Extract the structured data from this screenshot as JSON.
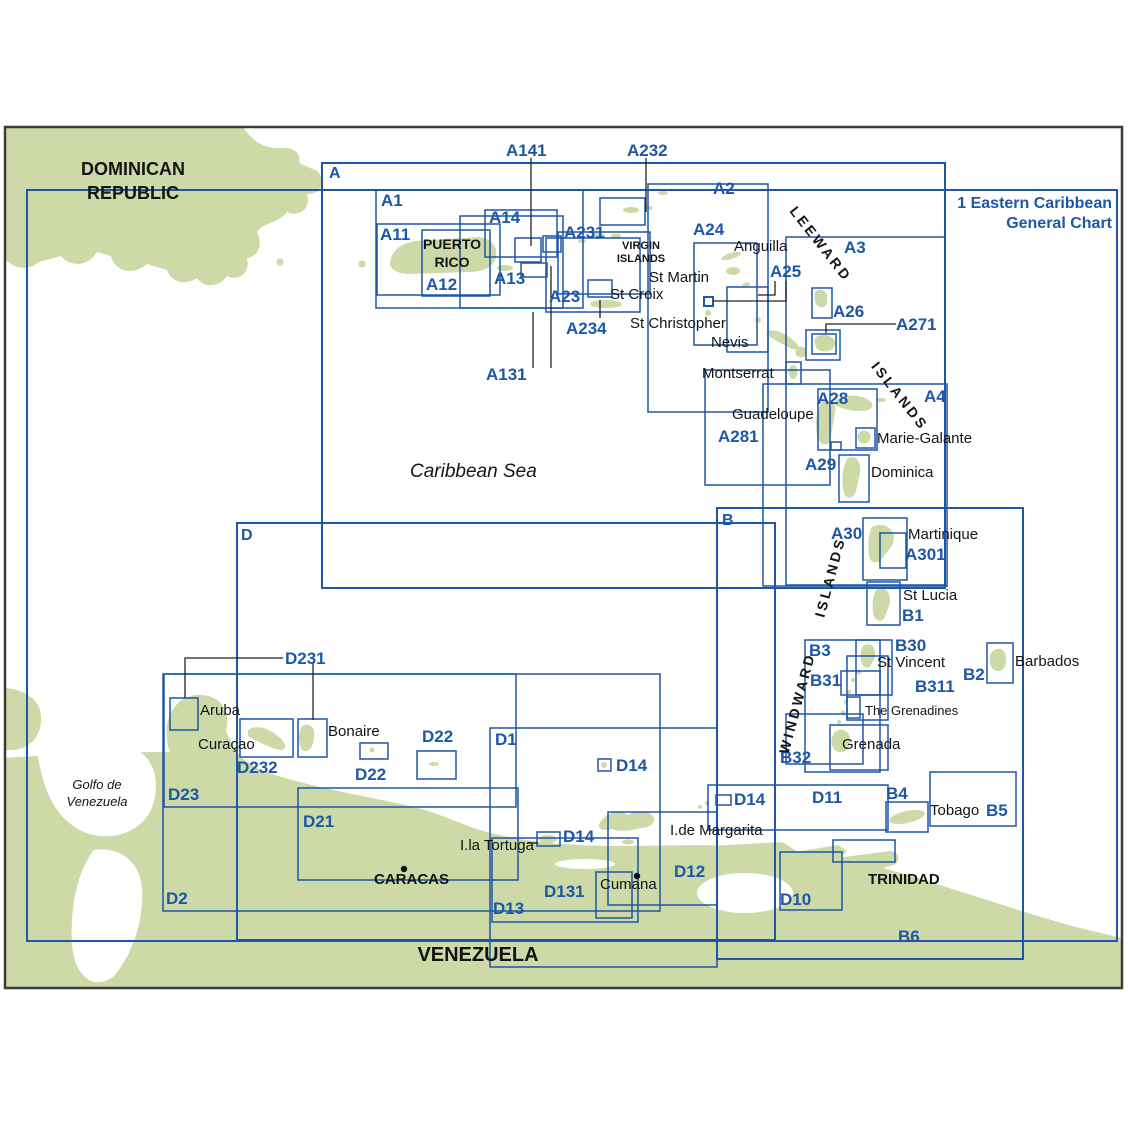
{
  "meta": {
    "title": "Eastern Caribbean chart index map",
    "colors": {
      "land": "#cdd9a6",
      "chart_line": "#1d57a5",
      "chart_text": "#1d57a5",
      "map_border": "#3c3c3c",
      "place_text": "#141414",
      "sea": "#ffffff"
    }
  },
  "general_chart": {
    "line1": "1 Eastern Caribbean",
    "line2": "General Chart"
  },
  "labels": [
    {
      "t": "1 Eastern Caribbean",
      "x": 1112,
      "y": 196,
      "c": "blue",
      "b": 1,
      "s": 16,
      "al": "right"
    },
    {
      "t": "General Chart",
      "x": 1112,
      "y": 216,
      "c": "blue",
      "b": 1,
      "s": 16,
      "al": "right"
    },
    {
      "t": "A",
      "x": 329,
      "y": 166,
      "c": "blue",
      "b": 1,
      "s": 16
    },
    {
      "t": "B",
      "x": 722,
      "y": 513,
      "c": "blue",
      "b": 1,
      "s": 16
    },
    {
      "t": "D",
      "x": 241,
      "y": 528,
      "c": "blue",
      "b": 1,
      "s": 16
    },
    {
      "t": "A1",
      "x": 381,
      "y": 192,
      "c": "blue",
      "b": 1,
      "s": 17
    },
    {
      "t": "A11",
      "x": 380,
      "y": 226,
      "c": "blue",
      "b": 1,
      "s": 17
    },
    {
      "t": "A12",
      "x": 426,
      "y": 276,
      "c": "blue",
      "b": 1,
      "s": 17
    },
    {
      "t": "A13",
      "x": 494,
      "y": 270,
      "c": "blue",
      "b": 1,
      "s": 17
    },
    {
      "t": "A14",
      "x": 489,
      "y": 209,
      "c": "blue",
      "b": 1,
      "s": 17
    },
    {
      "t": "A141",
      "x": 506,
      "y": 142,
      "c": "blue",
      "b": 1,
      "s": 17
    },
    {
      "t": "A232",
      "x": 627,
      "y": 142,
      "c": "blue",
      "b": 1,
      "s": 17
    },
    {
      "t": "A231",
      "x": 564,
      "y": 224,
      "c": "blue",
      "b": 1,
      "s": 17
    },
    {
      "t": "A2",
      "x": 713,
      "y": 180,
      "c": "blue",
      "b": 1,
      "s": 17
    },
    {
      "t": "A23",
      "x": 549,
      "y": 288,
      "c": "blue",
      "b": 1,
      "s": 17
    },
    {
      "t": "A234",
      "x": 566,
      "y": 320,
      "c": "blue",
      "b": 1,
      "s": 17
    },
    {
      "t": "A131",
      "x": 486,
      "y": 366,
      "c": "blue",
      "b": 1,
      "s": 17
    },
    {
      "t": "A24",
      "x": 693,
      "y": 221,
      "c": "blue",
      "b": 1,
      "s": 17
    },
    {
      "t": "A25",
      "x": 770,
      "y": 263,
      "c": "blue",
      "b": 1,
      "s": 17
    },
    {
      "t": "A3",
      "x": 844,
      "y": 239,
      "c": "blue",
      "b": 1,
      "s": 17
    },
    {
      "t": "A26",
      "x": 833,
      "y": 303,
      "c": "blue",
      "b": 1,
      "s": 17
    },
    {
      "t": "A271",
      "x": 896,
      "y": 316,
      "c": "blue",
      "b": 1,
      "s": 17
    },
    {
      "t": "A28",
      "x": 817,
      "y": 390,
      "c": "blue",
      "b": 1,
      "s": 17
    },
    {
      "t": "A281",
      "x": 718,
      "y": 428,
      "c": "blue",
      "b": 1,
      "s": 17
    },
    {
      "t": "A29",
      "x": 805,
      "y": 456,
      "c": "blue",
      "b": 1,
      "s": 17
    },
    {
      "t": "A4",
      "x": 924,
      "y": 388,
      "c": "blue",
      "b": 1,
      "s": 17
    },
    {
      "t": "A30",
      "x": 831,
      "y": 525,
      "c": "blue",
      "b": 1,
      "s": 17
    },
    {
      "t": "A301",
      "x": 905,
      "y": 546,
      "c": "blue",
      "b": 1,
      "s": 17
    },
    {
      "t": "B1",
      "x": 902,
      "y": 607,
      "c": "blue",
      "b": 1,
      "s": 17
    },
    {
      "t": "B3",
      "x": 809,
      "y": 642,
      "c": "blue",
      "b": 1,
      "s": 17
    },
    {
      "t": "B30",
      "x": 895,
      "y": 637,
      "c": "blue",
      "b": 1,
      "s": 17
    },
    {
      "t": "B31",
      "x": 810,
      "y": 672,
      "c": "blue",
      "b": 1,
      "s": 17
    },
    {
      "t": "B311",
      "x": 915,
      "y": 678,
      "c": "blue",
      "b": 1,
      "s": 17
    },
    {
      "t": "B2",
      "x": 963,
      "y": 666,
      "c": "blue",
      "b": 1,
      "s": 17
    },
    {
      "t": "B32",
      "x": 780,
      "y": 749,
      "c": "blue",
      "b": 1,
      "s": 17
    },
    {
      "t": "B4",
      "x": 886,
      "y": 785,
      "c": "blue",
      "b": 1,
      "s": 17
    },
    {
      "t": "B5",
      "x": 986,
      "y": 802,
      "c": "blue",
      "b": 1,
      "s": 17
    },
    {
      "t": "B6",
      "x": 898,
      "y": 928,
      "c": "blue",
      "b": 1,
      "s": 17
    },
    {
      "t": "D231",
      "x": 285,
      "y": 650,
      "c": "blue",
      "b": 1,
      "s": 17
    },
    {
      "t": "D232",
      "x": 237,
      "y": 759,
      "c": "blue",
      "b": 1,
      "s": 17
    },
    {
      "t": "D23",
      "x": 168,
      "y": 786,
      "c": "blue",
      "b": 1,
      "s": 17
    },
    {
      "t": "D22",
      "x": 355,
      "y": 766,
      "c": "blue",
      "b": 1,
      "s": 17
    },
    {
      "t": "D22",
      "x": 422,
      "y": 728,
      "c": "blue",
      "b": 1,
      "s": 17
    },
    {
      "t": "D1",
      "x": 495,
      "y": 731,
      "c": "blue",
      "b": 1,
      "s": 17
    },
    {
      "t": "D14",
      "x": 616,
      "y": 757,
      "c": "blue",
      "b": 1,
      "s": 17
    },
    {
      "t": "D14",
      "x": 734,
      "y": 791,
      "c": "blue",
      "b": 1,
      "s": 17
    },
    {
      "t": "D14",
      "x": 563,
      "y": 828,
      "c": "blue",
      "b": 1,
      "s": 17
    },
    {
      "t": "D21",
      "x": 303,
      "y": 813,
      "c": "blue",
      "b": 1,
      "s": 17
    },
    {
      "t": "D12",
      "x": 674,
      "y": 863,
      "c": "blue",
      "b": 1,
      "s": 17
    },
    {
      "t": "D131",
      "x": 544,
      "y": 883,
      "c": "blue",
      "b": 1,
      "s": 17
    },
    {
      "t": "D13",
      "x": 493,
      "y": 900,
      "c": "blue",
      "b": 1,
      "s": 17
    },
    {
      "t": "D11",
      "x": 812,
      "y": 789,
      "c": "blue",
      "b": 1,
      "s": 17
    },
    {
      "t": "D10",
      "x": 780,
      "y": 891,
      "c": "blue",
      "b": 1,
      "s": 17
    },
    {
      "t": "D2",
      "x": 166,
      "y": 890,
      "c": "blue",
      "b": 1,
      "s": 17
    },
    {
      "t": "DOMINICAN",
      "x": 133,
      "y": 160,
      "c": "black",
      "b": 1,
      "s": 18,
      "al": "center"
    },
    {
      "t": "REPUBLIC",
      "x": 133,
      "y": 184,
      "c": "black",
      "b": 1,
      "s": 18,
      "al": "center"
    },
    {
      "t": "PUERTO",
      "x": 452,
      "y": 237,
      "c": "black",
      "b": 1,
      "s": 14,
      "al": "center"
    },
    {
      "t": "RICO",
      "x": 452,
      "y": 255,
      "c": "black",
      "b": 1,
      "s": 14,
      "al": "center"
    },
    {
      "t": "VIRGIN",
      "x": 641,
      "y": 241,
      "c": "black",
      "b": 1,
      "s": 11,
      "al": "center"
    },
    {
      "t": "ISLANDS",
      "x": 641,
      "y": 254,
      "c": "black",
      "b": 1,
      "s": 11,
      "al": "center"
    },
    {
      "t": "CARACAS",
      "x": 374,
      "y": 872,
      "c": "black",
      "b": 1,
      "s": 15
    },
    {
      "t": "TRINIDAD",
      "x": 868,
      "y": 872,
      "c": "black",
      "b": 1,
      "s": 15
    },
    {
      "t": "VENEZUELA",
      "x": 478,
      "y": 945,
      "c": "black",
      "b": 1,
      "s": 20,
      "al": "center"
    },
    {
      "t": "Caribbean Sea",
      "x": 410,
      "y": 462,
      "c": "black",
      "i": 1,
      "s": 19
    },
    {
      "t": "Golfo de",
      "x": 97,
      "y": 778,
      "c": "black",
      "i": 1,
      "s": 13,
      "al": "center"
    },
    {
      "t": "Venezuela",
      "x": 97,
      "y": 795,
      "c": "black",
      "i": 1,
      "s": 13,
      "al": "center"
    },
    {
      "t": "LEEWARD",
      "x": 821,
      "y": 244,
      "c": "black",
      "b": 1,
      "s": 14,
      "ang": 52
    },
    {
      "t": "ISLANDS",
      "x": 900,
      "y": 396,
      "c": "black",
      "b": 1,
      "s": 14,
      "ang": 52
    },
    {
      "t": "ISLANDS",
      "x": 830,
      "y": 577,
      "c": "black",
      "b": 1,
      "s": 14,
      "ang": -75
    },
    {
      "t": "WINDWARD",
      "x": 797,
      "y": 703,
      "c": "black",
      "b": 1,
      "s": 14,
      "ang": -75
    },
    {
      "t": "Anguilla",
      "x": 734,
      "y": 239,
      "c": "black",
      "s": 15
    },
    {
      "t": "St Martin",
      "x": 649,
      "y": 270,
      "c": "black",
      "s": 15
    },
    {
      "t": "St Croix",
      "x": 610,
      "y": 287,
      "c": "black",
      "s": 15
    },
    {
      "t": "St Christopher",
      "x": 630,
      "y": 316,
      "c": "black",
      "s": 15
    },
    {
      "t": "Nevis",
      "x": 711,
      "y": 335,
      "c": "black",
      "s": 15
    },
    {
      "t": "Montserrat",
      "x": 702,
      "y": 366,
      "c": "black",
      "s": 15
    },
    {
      "t": "Guadeloupe",
      "x": 732,
      "y": 407,
      "c": "black",
      "s": 15
    },
    {
      "t": "Marie-Galante",
      "x": 877,
      "y": 431,
      "c": "black",
      "s": 15
    },
    {
      "t": "Dominica",
      "x": 871,
      "y": 465,
      "c": "black",
      "s": 15
    },
    {
      "t": "Martinique",
      "x": 908,
      "y": 527,
      "c": "black",
      "s": 15
    },
    {
      "t": "St Lucia",
      "x": 903,
      "y": 588,
      "c": "black",
      "s": 15
    },
    {
      "t": "St Vincent",
      "x": 877,
      "y": 655,
      "c": "black",
      "s": 15
    },
    {
      "t": "Barbados",
      "x": 1015,
      "y": 654,
      "c": "black",
      "s": 15
    },
    {
      "t": "The Grenadines",
      "x": 865,
      "y": 704,
      "c": "black",
      "s": 13
    },
    {
      "t": "Grenada",
      "x": 842,
      "y": 737,
      "c": "black",
      "s": 15
    },
    {
      "t": "Tobago",
      "x": 930,
      "y": 803,
      "c": "black",
      "s": 15
    },
    {
      "t": "I.de Margarita",
      "x": 670,
      "y": 823,
      "c": "black",
      "s": 15
    },
    {
      "t": "I.la Tortuga",
      "x": 460,
      "y": 838,
      "c": "black",
      "s": 15
    },
    {
      "t": "Cumana",
      "x": 600,
      "y": 877,
      "c": "black",
      "s": 15
    },
    {
      "t": "Aruba",
      "x": 200,
      "y": 703,
      "c": "black",
      "s": 15
    },
    {
      "t": "Curaçao",
      "x": 198,
      "y": 737,
      "c": "black",
      "s": 15
    },
    {
      "t": "Bonaire",
      "x": 328,
      "y": 724,
      "c": "black",
      "s": 15
    }
  ],
  "boxes": [
    {
      "id": "chart-1",
      "x": 27,
      "y": 190,
      "w": 1090,
      "h": 751,
      "sw": 2
    },
    {
      "id": "chart-A",
      "x": 322,
      "y": 163,
      "w": 623,
      "h": 425,
      "sw": 2
    },
    {
      "id": "chart-B",
      "x": 717,
      "y": 508,
      "w": 306,
      "h": 451,
      "sw": 2
    },
    {
      "id": "chart-D",
      "x": 237,
      "y": 523,
      "w": 538,
      "h": 417,
      "sw": 2
    },
    {
      "id": "chart-A1",
      "x": 376,
      "y": 190,
      "w": 207,
      "h": 118,
      "sw": 1.5
    },
    {
      "id": "chart-A11",
      "x": 377,
      "y": 224,
      "w": 123,
      "h": 71,
      "sw": 1.5
    },
    {
      "id": "chart-A12",
      "x": 422,
      "y": 230,
      "w": 68,
      "h": 66,
      "sw": 1.5
    },
    {
      "id": "chart-A13",
      "x": 460,
      "y": 216,
      "w": 103,
      "h": 92,
      "sw": 1.5
    },
    {
      "id": "chart-A14",
      "x": 485,
      "y": 210,
      "w": 72,
      "h": 47,
      "sw": 1.5
    },
    {
      "id": "chart-A141",
      "x": 515,
      "y": 238,
      "w": 26,
      "h": 24,
      "sw": 1.5
    },
    {
      "id": "chart-A131",
      "x": 521,
      "y": 263,
      "w": 26,
      "h": 14,
      "sw": 1.5
    },
    {
      "id": "chart-small-east-pr",
      "x": 543,
      "y": 236,
      "w": 18,
      "h": 16,
      "sw": 1.5
    },
    {
      "id": "chart-A23",
      "x": 546,
      "y": 238,
      "w": 94,
      "h": 74,
      "sw": 1.5
    },
    {
      "id": "chart-A231",
      "x": 558,
      "y": 232,
      "w": 92,
      "h": 62,
      "sw": 1.5
    },
    {
      "id": "chart-A232",
      "x": 600,
      "y": 198,
      "w": 45,
      "h": 27,
      "sw": 1.5
    },
    {
      "id": "chart-st-croix",
      "x": 588,
      "y": 280,
      "w": 24,
      "h": 17,
      "sw": 1.5
    },
    {
      "id": "chart-A2",
      "x": 648,
      "y": 184,
      "w": 120,
      "h": 228,
      "sw": 1.5
    },
    {
      "id": "chart-A24",
      "x": 694,
      "y": 243,
      "w": 63,
      "h": 102,
      "sw": 1.5
    },
    {
      "id": "chart-A25",
      "x": 727,
      "y": 287,
      "w": 41,
      "h": 65,
      "sw": 1.5
    },
    {
      "id": "chart-A3",
      "x": 786,
      "y": 237,
      "w": 159,
      "h": 348,
      "sw": 1.5
    },
    {
      "id": "chart-A4",
      "x": 763,
      "y": 384,
      "w": 184,
      "h": 202,
      "sw": 1.5
    },
    {
      "id": "chart-A26-barbuda",
      "x": 812,
      "y": 288,
      "w": 20,
      "h": 30,
      "sw": 1.5
    },
    {
      "id": "chart-antigua-outer",
      "x": 806,
      "y": 330,
      "w": 34,
      "h": 30,
      "sw": 1.5
    },
    {
      "id": "chart-A271-antigua",
      "x": 812,
      "y": 334,
      "w": 24,
      "h": 20,
      "sw": 1.5
    },
    {
      "id": "chart-montserrat",
      "x": 786,
      "y": 362,
      "w": 15,
      "h": 22,
      "sw": 1.5
    },
    {
      "id": "chart-A281",
      "x": 705,
      "y": 370,
      "w": 125,
      "h": 115,
      "sw": 1.5
    },
    {
      "id": "chart-A28",
      "x": 818,
      "y": 389,
      "w": 59,
      "h": 61,
      "sw": 1.5
    },
    {
      "id": "chart-marie-galante",
      "x": 856,
      "y": 428,
      "w": 19,
      "h": 20,
      "sw": 1.5
    },
    {
      "id": "chart-les-saintes",
      "x": 831,
      "y": 442,
      "w": 10,
      "h": 8,
      "sw": 1.5
    },
    {
      "id": "chart-A29",
      "x": 839,
      "y": 455,
      "w": 30,
      "h": 47,
      "sw": 1.5
    },
    {
      "id": "chart-A30",
      "x": 863,
      "y": 518,
      "w": 44,
      "h": 62,
      "sw": 1.5
    },
    {
      "id": "chart-A301",
      "x": 880,
      "y": 533,
      "w": 26,
      "h": 35,
      "sw": 1.5
    },
    {
      "id": "chart-B1",
      "x": 867,
      "y": 582,
      "w": 33,
      "h": 43,
      "sw": 1.5
    },
    {
      "id": "chart-B3",
      "x": 805,
      "y": 640,
      "w": 75,
      "h": 132,
      "sw": 1.5
    },
    {
      "id": "chart-B30",
      "x": 856,
      "y": 640,
      "w": 36,
      "h": 55,
      "sw": 1.5
    },
    {
      "id": "chart-B31",
      "x": 841,
      "y": 671,
      "w": 39,
      "h": 24,
      "sw": 1.5
    },
    {
      "id": "chart-B311",
      "x": 847,
      "y": 656,
      "w": 41,
      "h": 64,
      "sw": 1.5
    },
    {
      "id": "chart-grenadines",
      "x": 847,
      "y": 697,
      "w": 13,
      "h": 21,
      "sw": 1.5
    },
    {
      "id": "chart-grenada",
      "x": 830,
      "y": 725,
      "w": 58,
      "h": 45,
      "sw": 1.5
    },
    {
      "id": "chart-B32",
      "x": 786,
      "y": 714,
      "w": 77,
      "h": 50,
      "sw": 1.5
    },
    {
      "id": "chart-B2",
      "x": 987,
      "y": 643,
      "w": 26,
      "h": 40,
      "sw": 1.5
    },
    {
      "id": "chart-B4",
      "x": 886,
      "y": 802,
      "w": 42,
      "h": 30,
      "sw": 1.5
    },
    {
      "id": "chart-B5",
      "x": 930,
      "y": 772,
      "w": 86,
      "h": 54,
      "sw": 1.5
    },
    {
      "id": "chart-D23",
      "x": 164,
      "y": 674,
      "w": 352,
      "h": 133,
      "sw": 1.5
    },
    {
      "id": "chart-D2",
      "x": 163,
      "y": 674,
      "w": 497,
      "h": 237,
      "sw": 1.5
    },
    {
      "id": "chart-aruba",
      "x": 170,
      "y": 698,
      "w": 28,
      "h": 32,
      "sw": 1.5
    },
    {
      "id": "chart-curacao",
      "x": 240,
      "y": 719,
      "w": 53,
      "h": 38,
      "sw": 1.5
    },
    {
      "id": "chart-bonaire",
      "x": 298,
      "y": 719,
      "w": 29,
      "h": 38,
      "sw": 1.5
    },
    {
      "id": "chart-D22-west",
      "x": 360,
      "y": 743,
      "w": 28,
      "h": 16,
      "sw": 1.5
    },
    {
      "id": "chart-D22-east",
      "x": 417,
      "y": 751,
      "w": 39,
      "h": 28,
      "sw": 1.5
    },
    {
      "id": "chart-D21",
      "x": 298,
      "y": 788,
      "w": 220,
      "h": 92,
      "sw": 1.5
    },
    {
      "id": "chart-D1",
      "x": 490,
      "y": 728,
      "w": 227,
      "h": 239,
      "sw": 1.5
    },
    {
      "id": "chart-D13",
      "x": 492,
      "y": 838,
      "w": 146,
      "h": 84,
      "sw": 1.5
    },
    {
      "id": "chart-D131",
      "x": 596,
      "y": 872,
      "w": 36,
      "h": 46,
      "sw": 1.5
    },
    {
      "id": "chart-D12",
      "x": 608,
      "y": 812,
      "w": 109,
      "h": 93,
      "sw": 1.5
    },
    {
      "id": "chart-D14-blanquilla",
      "x": 598,
      "y": 759,
      "w": 13,
      "h": 12,
      "sw": 1.5
    },
    {
      "id": "chart-D14-east",
      "x": 716,
      "y": 795,
      "w": 15,
      "h": 10,
      "sw": 1.5
    },
    {
      "id": "chart-D14-tortuga",
      "x": 537,
      "y": 832,
      "w": 23,
      "h": 14,
      "sw": 1.5
    },
    {
      "id": "chart-D11",
      "x": 708,
      "y": 785,
      "w": 180,
      "h": 45,
      "sw": 1.5
    },
    {
      "id": "chart-D10",
      "x": 780,
      "y": 852,
      "w": 62,
      "h": 58,
      "sw": 1.5
    },
    {
      "id": "chart-trinidad-nw",
      "x": 833,
      "y": 840,
      "w": 62,
      "h": 22,
      "sw": 1.5
    },
    {
      "id": "chart-saba-marker",
      "x": 704,
      "y": 297,
      "w": 9,
      "h": 9,
      "sw": 2
    }
  ],
  "connectors": [
    {
      "id": "leader-A141",
      "pts": "531,158 531,246"
    },
    {
      "id": "leader-A232",
      "pts": "646,158 646,212"
    },
    {
      "id": "leader-A131-a",
      "pts": "533,368 533,312"
    },
    {
      "id": "leader-A131-b",
      "pts": "551,368 551,266"
    },
    {
      "id": "leader-A234",
      "pts": "600,300 600,318"
    },
    {
      "id": "leader-A271",
      "pts": "896,324 826,324 826,333"
    },
    {
      "id": "leader-A25-a",
      "pts": "775,281 775,295 758,295"
    },
    {
      "id": "leader-A25-b",
      "pts": "786,281 786,301 714,301"
    },
    {
      "id": "leader-D231-aruba",
      "pts": "283,658 185,658 185,698"
    },
    {
      "id": "leader-D231-bonaire",
      "pts": "313,662 313,720"
    },
    {
      "id": "leader-tortuga",
      "pts": "527,843 538,843"
    }
  ],
  "dots": [
    {
      "id": "caracas-dot",
      "x": 404,
      "y": 869,
      "r": 3.2
    },
    {
      "id": "cumana-dot",
      "x": 637,
      "y": 876,
      "r": 3.2
    }
  ]
}
